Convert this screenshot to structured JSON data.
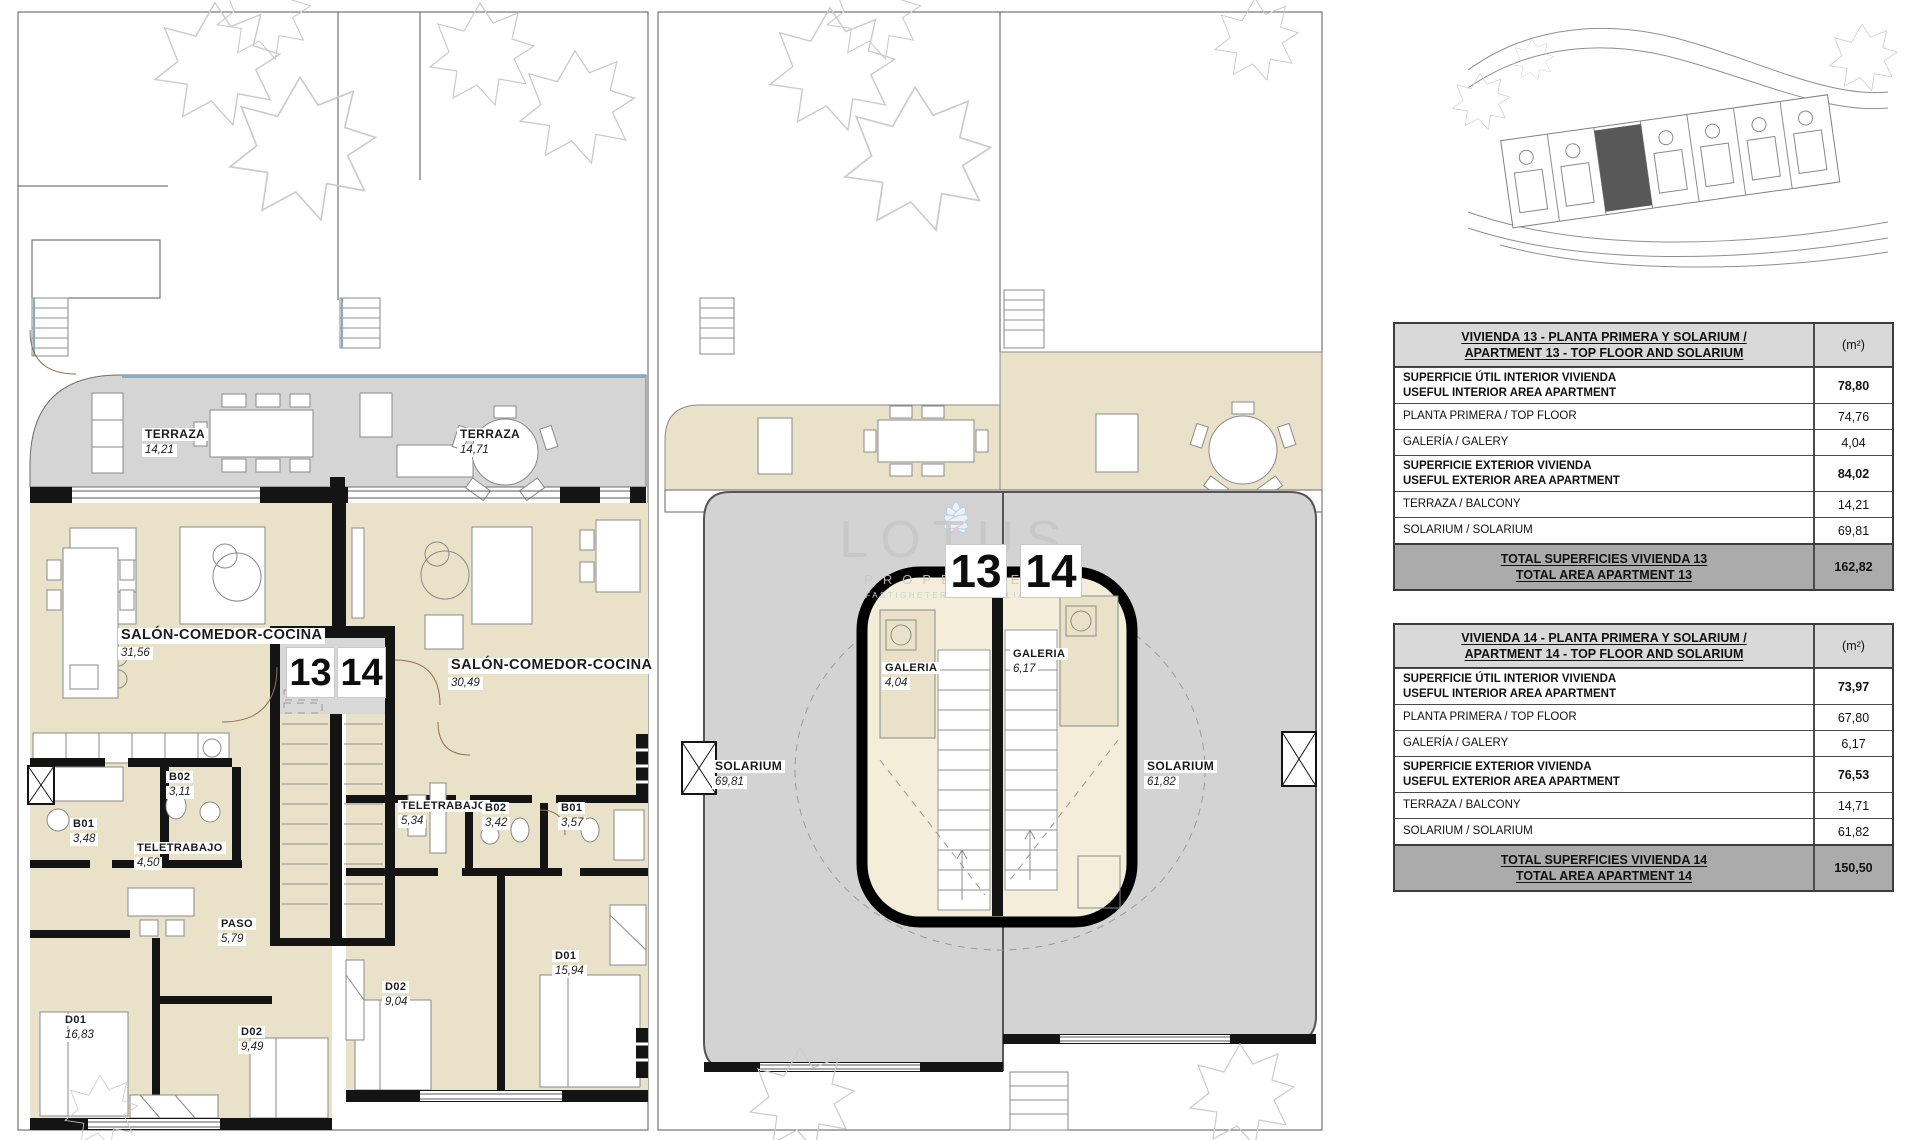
{
  "watermark": {
    "brand": "LOTUS",
    "subtitle": "PROPERTIES",
    "tagline": "FASTIGHETER · INMOBILIARIA"
  },
  "plan_level1": {
    "unit_numbers": {
      "left": "13",
      "right": "14"
    },
    "rooms": [
      {
        "name": "TERRAZA",
        "area": "14,21"
      },
      {
        "name": "TERRAZA",
        "area": "14,71"
      },
      {
        "name": "SALÓN-COMEDOR-COCINA",
        "area": "31,56"
      },
      {
        "name": "SALÓN-COMEDOR-COCINA",
        "area": "30,49"
      },
      {
        "name": "B02",
        "area": "3,11"
      },
      {
        "name": "B01",
        "area": "3,48"
      },
      {
        "name": "TELETRABAJO",
        "area": "4,50"
      },
      {
        "name": "TELETRABAJO",
        "area": "5,34"
      },
      {
        "name": "B02",
        "area": "3,42"
      },
      {
        "name": "B01",
        "area": "3,57"
      },
      {
        "name": "PASO",
        "area": "5,79"
      },
      {
        "name": "D02",
        "area": "9,04"
      },
      {
        "name": "D01",
        "area": "15,94"
      },
      {
        "name": "D01",
        "area": "16,83"
      },
      {
        "name": "D02",
        "area": "9,49"
      }
    ]
  },
  "plan_solarium": {
    "unit_numbers": {
      "left": "13",
      "right": "14"
    },
    "rooms": [
      {
        "name": "GALERIA",
        "area": "4,04"
      },
      {
        "name": "GALERIA",
        "area": "6,17"
      },
      {
        "name": "SOLARIUM",
        "area": "69,81"
      },
      {
        "name": "SOLARIUM",
        "area": "61,82"
      }
    ]
  },
  "tables": [
    {
      "title_line1": "VIVIENDA 13 - PLANTA PRIMERA Y SOLARIUM /",
      "title_line2": "APARTMENT 13 - TOP FLOOR AND SOLARIUM",
      "unit_header": "(m²)",
      "rows": [
        {
          "label_line1": "SUPERFICIE ÚTIL INTERIOR VIVIENDA",
          "label_line2": "USEFUL INTERIOR AREA APARTMENT",
          "value": "78,80"
        },
        {
          "label_line1": "PLANTA PRIMERA / TOP FLOOR",
          "value": "74,76"
        },
        {
          "label_line1": "GALERÍA / GALERY",
          "value": "4,04"
        },
        {
          "label_line1": "SUPERFICIE EXTERIOR VIVIENDA",
          "label_line2": "USEFUL EXTERIOR AREA APARTMENT",
          "value": "84,02"
        },
        {
          "label_line1": "TERRAZA / BALCONY",
          "value": "14,21"
        },
        {
          "label_line1": "SOLARIUM / SOLARIUM",
          "value": "69,81"
        }
      ],
      "total_line1": "TOTAL SUPERFICIES VIVIENDA 13",
      "total_line2": "TOTAL AREA APARTMENT 13",
      "total_value": "162,82"
    },
    {
      "title_line1": "VIVIENDA 14 - PLANTA PRIMERA Y SOLARIUM /",
      "title_line2": "APARTMENT 14 - TOP FLOOR AND SOLARIUM",
      "unit_header": "(m²)",
      "rows": [
        {
          "label_line1": "SUPERFICIE ÚTIL INTERIOR VIVIENDA",
          "label_line2": "USEFUL INTERIOR AREA APARTMENT",
          "value": "73,97"
        },
        {
          "label_line1": "PLANTA PRIMERA / TOP FLOOR",
          "value": "67,80"
        },
        {
          "label_line1": "GALERÍA / GALERY",
          "value": "6,17"
        },
        {
          "label_line1": "SUPERFICIE EXTERIOR VIVIENDA",
          "label_line2": "USEFUL EXTERIOR AREA APARTMENT",
          "value": "76,53"
        },
        {
          "label_line1": "TERRAZA / BALCONY",
          "value": "14,71"
        },
        {
          "label_line1": "SOLARIUM / SOLARIUM",
          "value": "61,82"
        }
      ],
      "total_line1": "TOTAL SUPERFICIES VIVIENDA 14",
      "total_line2": "TOTAL AREA APARTMENT 14",
      "total_value": "150,50"
    }
  ]
}
